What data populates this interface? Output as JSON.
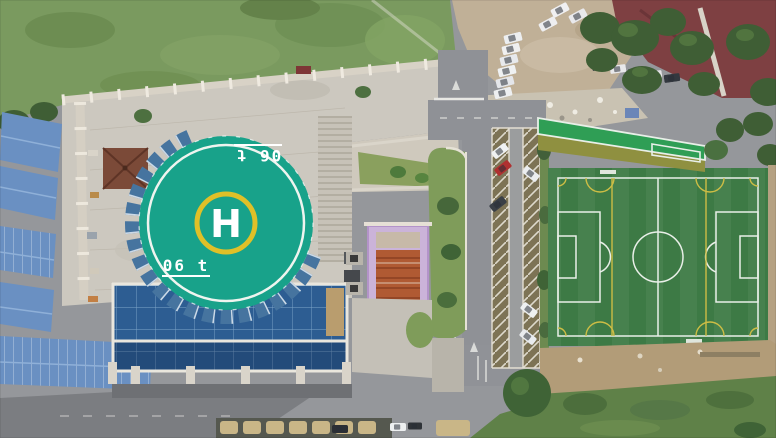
{
  "scene": {
    "type": "aerial-drone-photo",
    "caption": "Aerial view of a rooftop helipad on a glass building, campus plaza, parking lane and artificial soccer pitch",
    "helipad": {
      "letter": "H",
      "weight_marking": "06 t",
      "pad_color": "#18a28a",
      "perimeter_ring_color": "#eef4ef",
      "touchdown_ring_color": "#dfc028"
    },
    "soccer_field": {
      "turf_color": "#3d7a45",
      "line_color_primary": "#e9efe8",
      "line_color_secondary": "#cdbd45"
    },
    "colors": {
      "road_asphalt": "#95979b",
      "plaza_concrete": "#ccc8bf",
      "glass_roof_blue": "#2d5d92",
      "glass_grid_line": "#7fa6c9",
      "shed_roof_blue": "#6a90c2",
      "scrub_grass": "#7a9a5f",
      "median_grass": "#7f9c5a",
      "tree_green": "#3f5e35",
      "dirt_lot": "#c0b097",
      "rubble": "#c9c2b2",
      "maroon_roof": "#7e4042",
      "stand_roof_green": "#2f9e55",
      "stand_lower_olive": "#8f9040",
      "pavilion_roof_brown": "#7b4a38",
      "construction_pink": "#cbb3d9",
      "construction_orange": "#b05a33",
      "dirt_south": "#b29c78",
      "scrub_south": "#5f8148",
      "shadow_pavement": "#7b7d81",
      "parking_slot": "#7d7355",
      "hedge_tan": "#c9b687"
    },
    "vehicles": {
      "white_cars_dirt_lot": 9,
      "cars_under_trees": 5,
      "cars_in_parking_lane": 6,
      "red_cars": 1,
      "cars_bottom_road": 3
    }
  }
}
